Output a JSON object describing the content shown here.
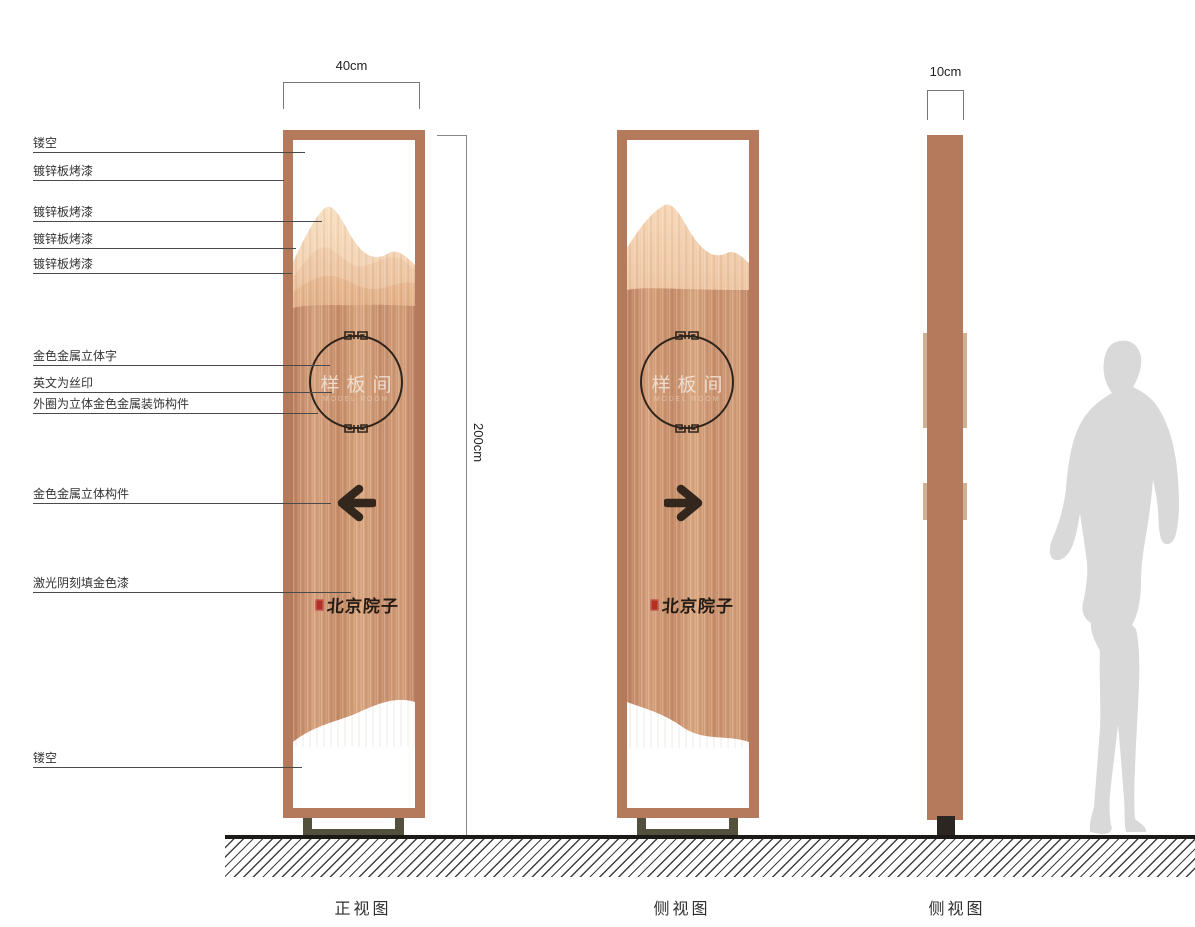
{
  "dimensions": {
    "front_width": "40cm",
    "height": "200cm",
    "side_width": "10cm"
  },
  "annotations": [
    {
      "label": "镂空"
    },
    {
      "label": "镀锌板烤漆"
    },
    {
      "label": "镀锌板烤漆"
    },
    {
      "label": "镀锌板烤漆"
    },
    {
      "label": "镀锌板烤漆"
    },
    {
      "label": "金色金属立体字"
    },
    {
      "label": "英文为丝印"
    },
    {
      "label": "外圈为立体金色金属装饰构件"
    },
    {
      "label": "金色金属立体构件"
    },
    {
      "label": "激光阴刻填金色漆"
    },
    {
      "label": "镂空"
    }
  ],
  "panel": {
    "sign_text": "样板间",
    "sign_subtext": "MODEL ROOM",
    "brand_text": "北京院子"
  },
  "captions": {
    "front": "正视图",
    "side1": "侧视图",
    "side2": "侧视图"
  },
  "colors": {
    "frame_copper": "#b57a5b",
    "copper_light": "#d9a67f",
    "copper_dark": "#bc7f5e",
    "mountain_light": "#f4d8bd",
    "ornament_dark": "#2f241b",
    "seal_red": "#b23022",
    "base_olive": "#53503e",
    "ground_hatch": "#3f3f3f",
    "silhouette_gray": "#d9d9d9"
  }
}
